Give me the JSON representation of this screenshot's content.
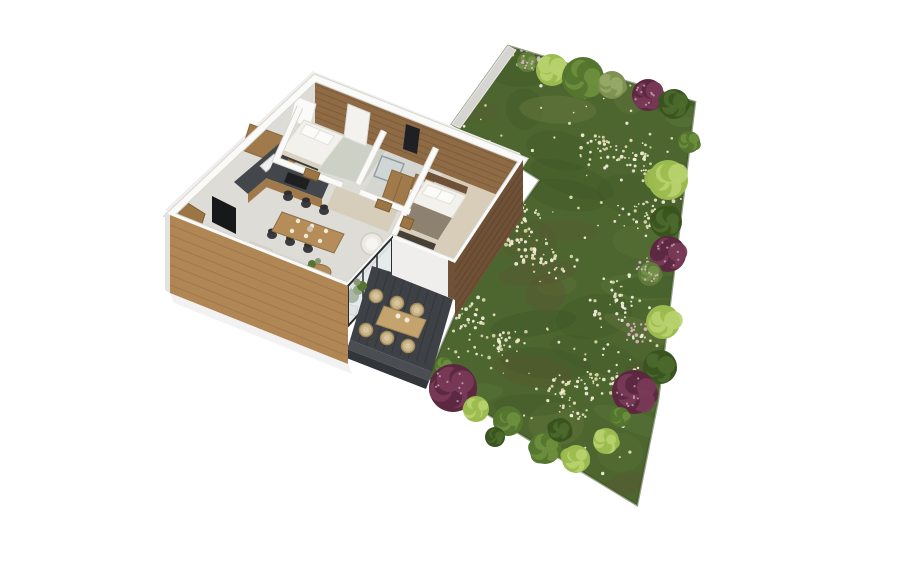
{
  "scene": {
    "kind": "isometric-floorplan-render",
    "background": "#ffffff"
  },
  "palette": {
    "grassBase": "#4d6630",
    "grassDark": "#3d5526",
    "grassLight": "#5d7c3c",
    "grassOlive": "#6e7c42",
    "grassBrown": "#5b5531",
    "grassEdge": "#3a5222",
    "flowerCream": "#ece5c2",
    "flowerWhite": "#f7f4e1",
    "flowerYellow": "#dfd9a6",
    "flowerPink": "#e0b3c6",
    "gardenWall": "#d6d5d1",
    "woodFacade": "#b18655",
    "woodFacadeLine": "#8f6a3e",
    "woodEast": "#6e5136",
    "woodEastLine": "#553e27",
    "woodPanel": "#8f6b45",
    "woodPanelLine": "#6b4c30",
    "woodCabinet": "#a07a4a",
    "woodDoor": "#9c7544",
    "woodTable": "#b68d58",
    "woodTableDark": "#8d7147",
    "counterDark": "#43464a",
    "stoveBlack": "#1e1f20",
    "floorMain": "#dedcd7",
    "floorBed1": "#cdd0c4",
    "floorBed2": "#d8cdb9",
    "floorBath": "#d5d6d2",
    "floorHall": "#d6cdbb",
    "wallWhite": "#fafaf8",
    "wallShadow": "#d8d6d2",
    "wallFaceWhite": "#efeeec",
    "deck": "#3e4246",
    "deckLine": "#32363a",
    "deckStep": "#4a4e53",
    "sofaWhite": "#eceae4",
    "sofaShadow": "#d4d0c6",
    "cushionTan": "#b9a988",
    "linenWhite": "#f2f1ec",
    "blanketTaupe": "#8d8170",
    "blanketCream": "#d9d3c5",
    "benchDark": "#474038",
    "chairDark": "#3b3b3f",
    "rattan": "#c9b489",
    "rattanDark": "#a28a58",
    "outdoorTable": "#c4a36d",
    "glass": "#ccd6d8",
    "glassFrame": "#2c2f31",
    "mirrorDark": "#1f2023",
    "tvBlack": "#17181a",
    "plantGreen": "#55752f",
    "plantSage": "#8b9678",
    "potWhite": "#f4f3ef",
    "shadow": "#000000",
    "bushTypes": {
      "purple": [
        "#5b2840",
        "#7a3a58",
        "#c59db5"
      ],
      "lightgreen": [
        "#9cbb4f",
        "#b9d36e",
        null
      ],
      "green": [
        "#55752f",
        "#6d8f3e",
        null
      ],
      "darkgreen": [
        "#3a5420",
        "#4c6a2c",
        null
      ],
      "sage": [
        "#7e9150",
        "#97a968",
        null
      ],
      "flower": [
        "#5e7a38",
        "#74924a",
        "#e3b7ca"
      ]
    }
  },
  "garden": {
    "outline": [
      [
        508,
        46
      ],
      [
        695,
        102
      ],
      [
        658,
        400
      ],
      [
        637,
        505
      ],
      [
        428,
        378
      ],
      [
        470,
        280
      ],
      [
        540,
        180
      ],
      [
        452,
        124
      ]
    ],
    "bushes": [
      [
        527,
        62,
        10,
        "flower"
      ],
      [
        552,
        70,
        16,
        "lightgreen"
      ],
      [
        583,
        78,
        21,
        "green"
      ],
      [
        612,
        85,
        14,
        "sage"
      ],
      [
        648,
        95,
        16,
        "purple"
      ],
      [
        674,
        104,
        15,
        "darkgreen"
      ],
      [
        689,
        142,
        11,
        "green"
      ],
      [
        668,
        180,
        20,
        "lightgreen"
      ],
      [
        666,
        222,
        16,
        "darkgreen"
      ],
      [
        668,
        254,
        18,
        "purple"
      ],
      [
        650,
        274,
        12,
        "flower"
      ],
      [
        663,
        322,
        17,
        "lightgreen"
      ],
      [
        660,
        367,
        17,
        "darkgreen"
      ],
      [
        634,
        392,
        22,
        "purple"
      ],
      [
        444,
        366,
        9,
        "green"
      ],
      [
        453,
        388,
        24,
        "purple"
      ],
      [
        476,
        409,
        13,
        "lightgreen"
      ],
      [
        508,
        421,
        15,
        "green"
      ],
      [
        495,
        437,
        10,
        "darkgreen"
      ],
      [
        545,
        448,
        16,
        "green"
      ],
      [
        576,
        459,
        14,
        "lightgreen"
      ],
      [
        606,
        441,
        13,
        "lightgreen"
      ],
      [
        560,
        430,
        12,
        "darkgreen"
      ],
      [
        620,
        417,
        10,
        "green"
      ]
    ],
    "flowerClusters": [
      [
        600,
        150
      ],
      [
        545,
        260
      ],
      [
        620,
        300
      ],
      [
        500,
        345
      ],
      [
        565,
        395
      ],
      [
        485,
        185
      ],
      [
        648,
        215
      ],
      [
        590,
        72
      ],
      [
        520,
        240
      ],
      [
        610,
        380
      ],
      [
        470,
        320
      ],
      [
        640,
        160
      ]
    ],
    "pinkPatches": [
      [
        650,
        272
      ],
      [
        638,
        332
      ],
      [
        527,
        60
      ]
    ]
  },
  "furniture": {
    "diningChairs": [
      [
        288,
        197
      ],
      [
        306,
        204
      ],
      [
        324,
        211
      ],
      [
        272,
        235
      ],
      [
        290,
        242
      ],
      [
        308,
        249
      ]
    ],
    "placeSettings": [
      [
        298,
        221
      ],
      [
        312,
        226
      ],
      [
        326,
        231
      ],
      [
        292,
        231
      ],
      [
        306,
        236
      ],
      [
        320,
        241
      ]
    ],
    "outdoorChairs": [
      [
        376,
        296
      ],
      [
        397,
        303
      ],
      [
        417,
        310
      ],
      [
        366,
        330
      ],
      [
        387,
        338
      ],
      [
        408,
        346
      ]
    ],
    "outdoorSettings": [
      [
        398,
        316
      ],
      [
        407,
        320
      ]
    ]
  }
}
